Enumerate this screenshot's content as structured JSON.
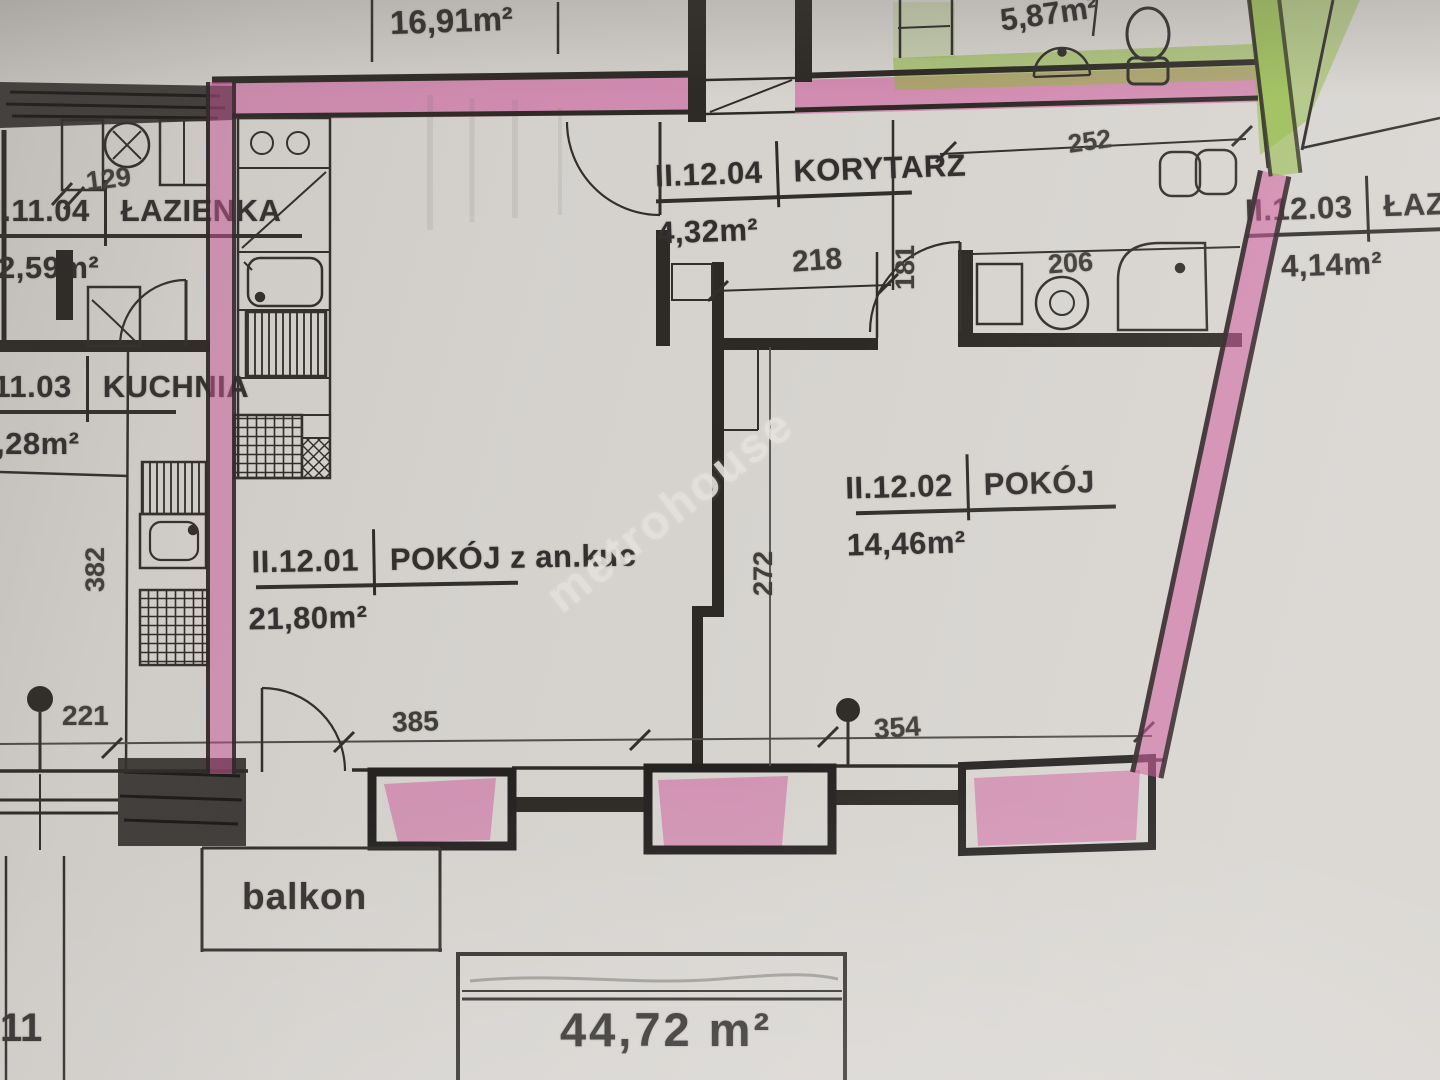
{
  "watermark": "metrohouse",
  "areas": {
    "upper_left_unit": "16,91m²",
    "upper_right_bath": "5,87m²",
    "total": "44,72 m²"
  },
  "rooms": {
    "lazienka_left": {
      "code": "II.11.04",
      "name": "ŁAZIENKA",
      "area": "2,59m²"
    },
    "kuchnia": {
      "code": "II.11.03",
      "name": "KUCHNIA",
      "area": ",28m²"
    },
    "korytarz": {
      "code": "II.12.04",
      "name": "KORYTARZ",
      "area": "4,32m²"
    },
    "pokoj_main": {
      "code": "II.12.01",
      "name": "POKÓJ z an.kuc",
      "area": "21,80m²"
    },
    "pokoj2": {
      "code": "II.12.02",
      "name": "POKÓJ",
      "area": "14,46m²"
    },
    "lazienka_right": {
      "code": "II.12.03",
      "name": "ŁAZIE",
      "area": "4,14m²"
    }
  },
  "labels": {
    "balcony": "balkon",
    "corner_fragment": "11"
  },
  "dimensions": {
    "left_bath_width": "129",
    "top_right_width": "252",
    "corridor_width": "218",
    "corridor_depth": "181",
    "bath_width": "206",
    "room2_height": "272",
    "kitchen_height": "382",
    "balcony_left": "221",
    "window_main": "385",
    "window_room2": "354"
  },
  "fixtures": [
    "toilet-icon",
    "washbasin-icon",
    "kitchen-sink-icon",
    "stove-icon",
    "fridge-icon",
    "shower-icon",
    "washing-machine-icon",
    "balcony-door-icon"
  ],
  "colors": {
    "highlight_pink": "#cf4f97",
    "highlight_green": "#8ab832",
    "wall": "#26231f",
    "paper": "#d9d6d2"
  }
}
